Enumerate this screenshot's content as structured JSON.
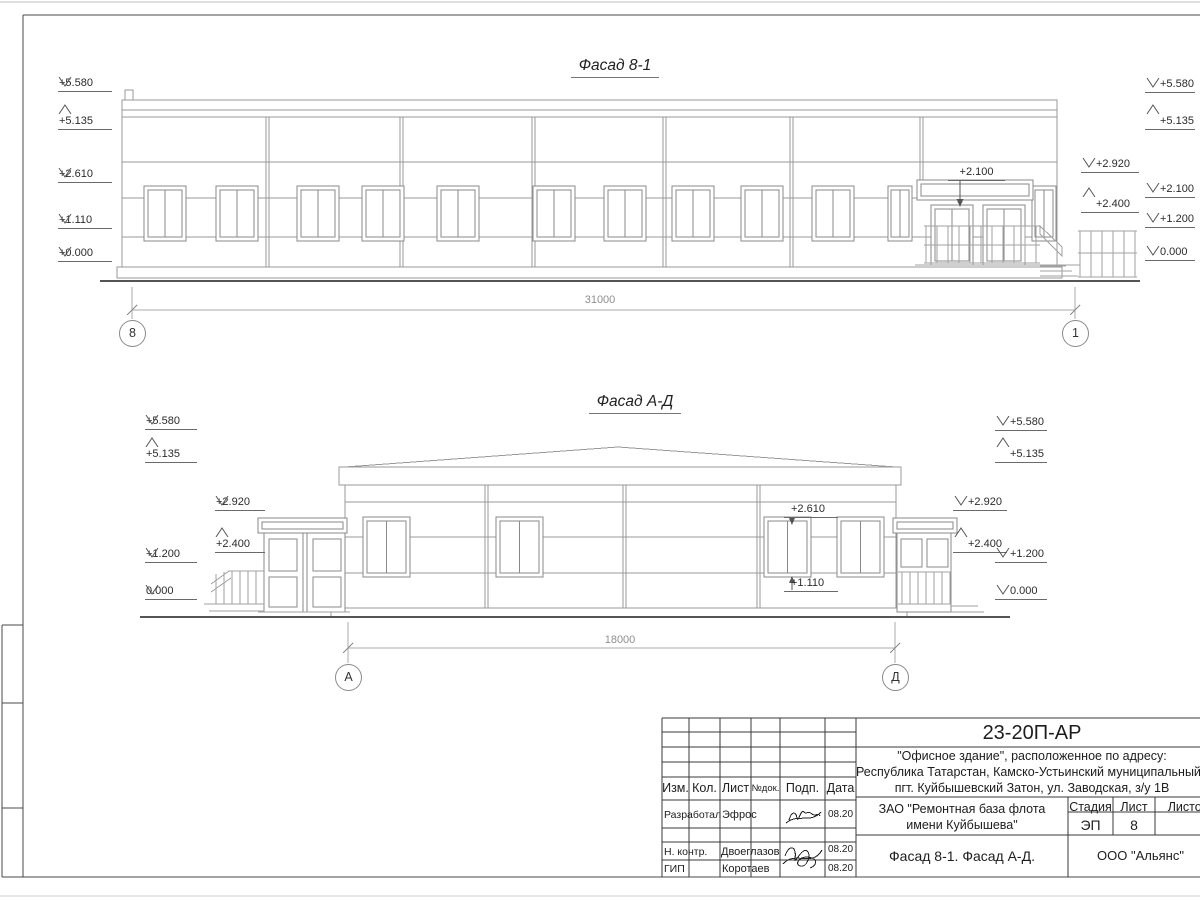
{
  "facade1": {
    "title": "Фасад 8-1",
    "dimension": "31000",
    "axis_left": "8",
    "axis_right": "1",
    "marks_left": [
      "+5.580",
      "+5.135",
      "+2.610",
      "+1.110",
      "+0.000"
    ],
    "marks_right_inner": [
      "+2.920",
      "+2.400"
    ],
    "marks_right_outer": [
      "+5.580",
      "+5.135",
      "+2.100",
      "+1.200",
      "0.000"
    ],
    "entrance_mark": "+2.100"
  },
  "facade2": {
    "title": "Фасад А-Д",
    "dimension": "18000",
    "axis_left": "А",
    "axis_right": "Д",
    "marks_left_outer": [
      "+5.580",
      "+5.135",
      "+1.200",
      "0.000"
    ],
    "marks_left_inner": [
      "+2.920",
      "+2.400"
    ],
    "marks_right_inner": [
      "+2.920",
      "+2.400"
    ],
    "marks_right_outer": [
      "+5.580",
      "+5.135",
      "+1.200",
      "0.000"
    ],
    "window_top_mark": "+2.610",
    "window_bottom_mark": "+1.110"
  },
  "title_block": {
    "code": "23-20П-АР",
    "address_lines": [
      "\"Офисное здание\", расположенное по адресу:",
      "Республика Татарстан, Камско-Устьинский муниципальный район,",
      "пгт. Куйбышевский Затон, ул. Заводская, з/у 1В"
    ],
    "client_lines": [
      "ЗАО \"Ремонтная база флота",
      "имени Куйбышева\""
    ],
    "sheet_title": "Фасад 8-1. Фасад А-Д.",
    "company": "ООО \"Альянс\"",
    "stage_label": "Стадия",
    "sheet_label": "Лист",
    "sheets_label": "Листов",
    "stage_value": "ЭП",
    "sheet_value": "8",
    "header_columns": [
      "Изм.",
      "Кол.",
      "Лист",
      "№док.",
      "Подп.",
      "Дата"
    ],
    "signature_rows": [
      {
        "role": "Разработал",
        "name": "Эфрос",
        "date": "08.20"
      },
      {
        "role": "Н. контр.",
        "name": "Двоеглазов",
        "date": "08.20"
      },
      {
        "role": "ГИП",
        "name": "Коротаев",
        "date": "08.20"
      }
    ]
  }
}
